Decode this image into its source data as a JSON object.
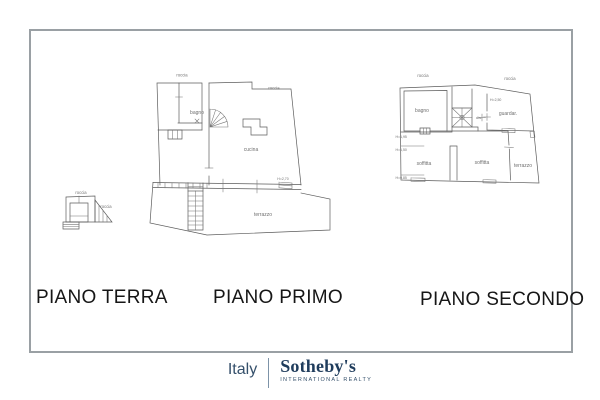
{
  "colors": {
    "frame_border": "#9aa0a4",
    "plan_line": "#5c5c5c",
    "label_gray": "#707070",
    "title_text": "#161616",
    "brand_navy": "#1f3c5c"
  },
  "floors": [
    {
      "title": "PIANO TERRA",
      "site_labels": {
        "roccia_top": "roccia",
        "roccia_side": "roccia"
      }
    },
    {
      "title": "PIANO PRIMO",
      "site_labels": {
        "roccia_left": "roccia",
        "roccia_right": "roccia"
      },
      "rooms": {
        "bagno": "bagno",
        "cucina": "cucina",
        "terrazzo": "terrazzo"
      },
      "heights": {
        "cucina": "H=2,70"
      }
    },
    {
      "title": "PIANO SECONDO",
      "site_labels": {
        "roccia_left": "roccia",
        "roccia_right": "roccia"
      },
      "rooms": {
        "bagno": "bagno",
        "dis": "dis.",
        "guardaroba": "guardar.",
        "soffitta_left": "soffitta",
        "soffitta_center": "soffitta",
        "terrazzo": "terrazzo"
      },
      "heights": {
        "guardaroba": "H=2,50",
        "left_upper": "H=1,95",
        "left_mid": "H=1,50",
        "left_lower": "H=0,85"
      }
    }
  ],
  "branding": {
    "country": "Italy",
    "brand": "Sotheby's",
    "tagline": "INTERNATIONAL REALTY"
  }
}
